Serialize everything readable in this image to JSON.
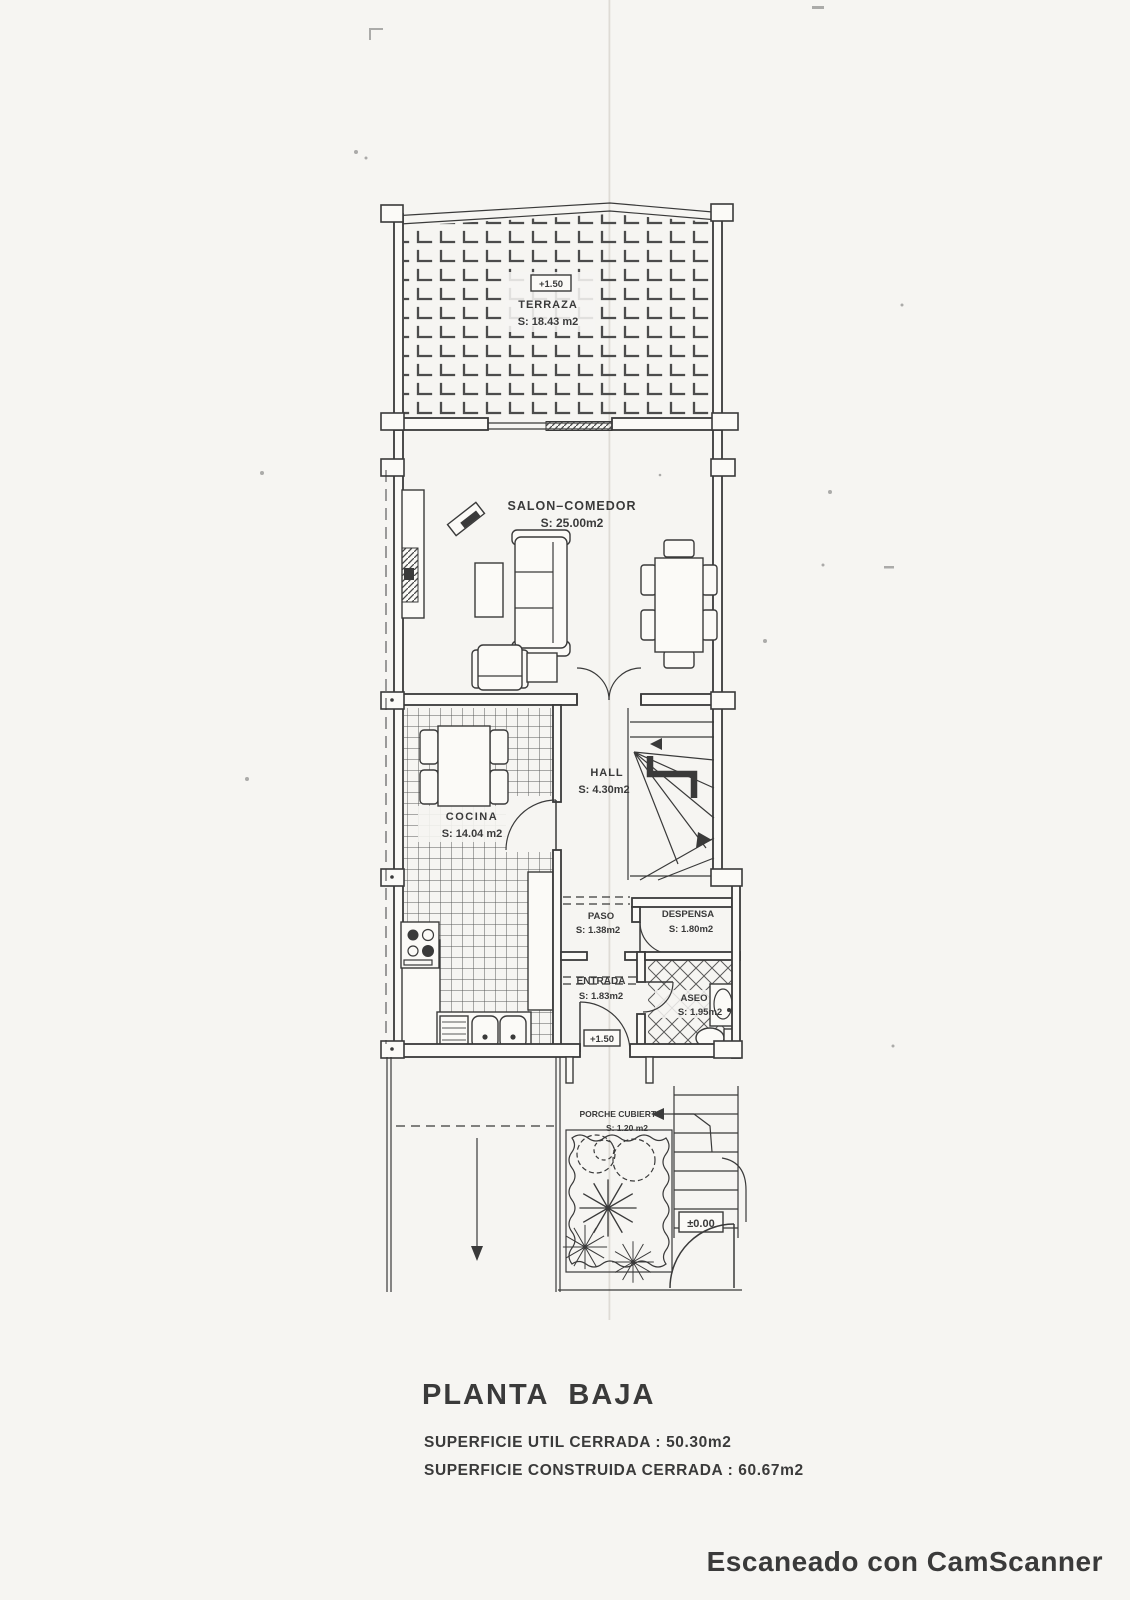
{
  "document": {
    "type": "scanned architectural floor plan",
    "colors": {
      "ink": "#3a3a3a",
      "paper": "#f6f5f2"
    }
  },
  "rooms": [
    {
      "id": "terraza",
      "label": "TERRAZA",
      "area": "S: 18.43 m2",
      "level": "+1.50"
    },
    {
      "id": "salon",
      "label": "SALON–COMEDOR",
      "area": "S: 25.00m2"
    },
    {
      "id": "hall",
      "label": "HALL",
      "area": "S: 4.30m2"
    },
    {
      "id": "cocina",
      "label": "COCINA",
      "area": "S: 14.04 m2"
    },
    {
      "id": "paso",
      "label": "PASO",
      "area": "S: 1.38m2"
    },
    {
      "id": "despensa",
      "label": "DESPENSA",
      "area": "S: 1.80m2"
    },
    {
      "id": "entrada",
      "label": "ENTRADA",
      "area": "S: 1.83m2",
      "level": "+1.50"
    },
    {
      "id": "aseo",
      "label": "ASEO",
      "area": "S: 1.95m2"
    },
    {
      "id": "porche",
      "label": "PORCHE CUBIERTO",
      "area": "S: 1.20 m2"
    }
  ],
  "levels": {
    "exterior": "±0.00"
  },
  "footer": {
    "title": "PLANTA BAJA",
    "line1": "SUPERFICIE UTIL CERRADA : 50.30m2",
    "line2": "SUPERFICIE CONSTRUIDA CERRADA : 60.67m2"
  },
  "watermark": {
    "text": "Escaneado con CamScanner"
  }
}
